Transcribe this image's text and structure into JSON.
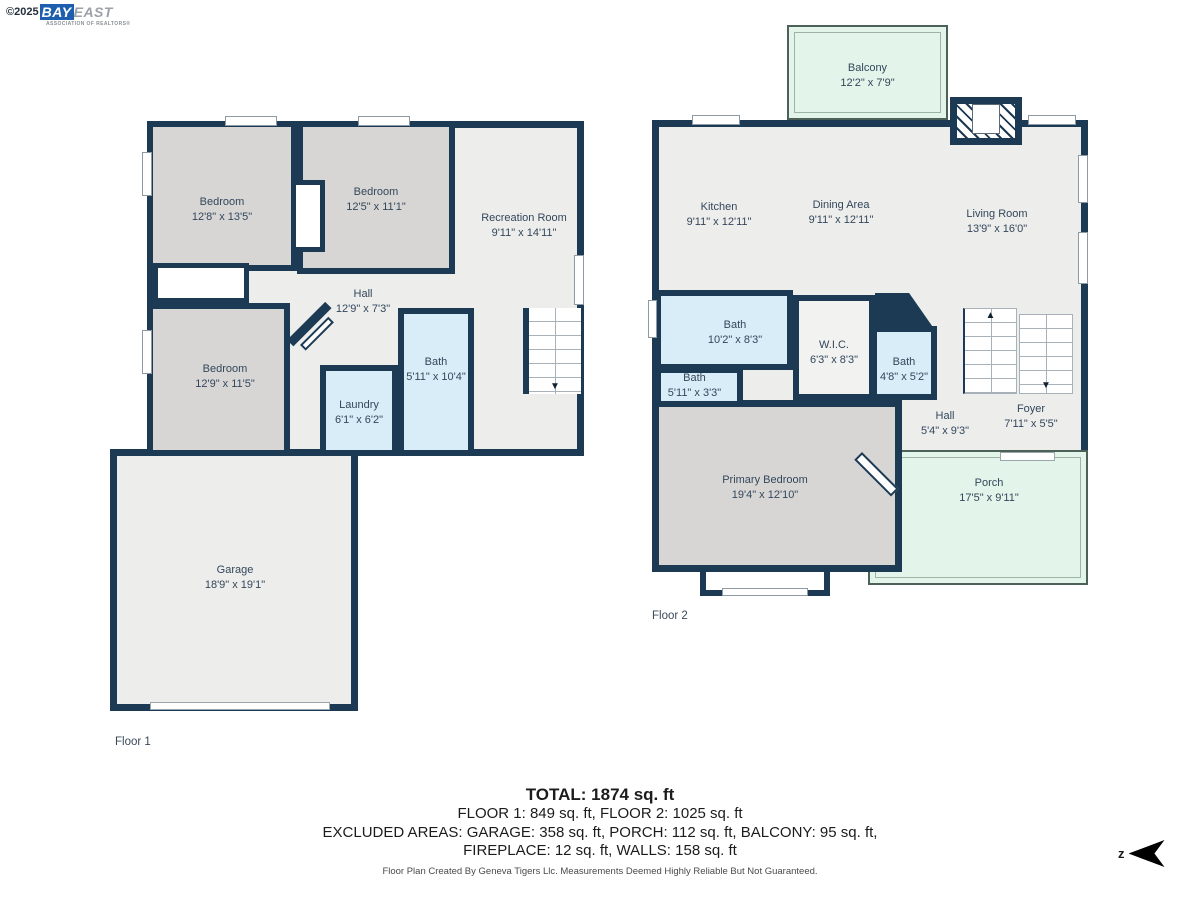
{
  "logo": {
    "copyright": "©2025",
    "brand_primary": "BAY",
    "brand_secondary": "EAST",
    "tagline": "ASSOCIATION OF REALTORS®"
  },
  "floor1": {
    "tag": "Floor 1",
    "rooms": {
      "bedroom_top_left": {
        "name": "Bedroom",
        "dims": "12'8\" x 13'5\""
      },
      "bedroom_top_mid": {
        "name": "Bedroom",
        "dims": "12'5\" x 11'1\""
      },
      "recreation": {
        "name": "Recreation Room",
        "dims": "9'11\" x 14'11\""
      },
      "hall": {
        "name": "Hall",
        "dims": "12'9\" x 7'3\""
      },
      "bedroom_left": {
        "name": "Bedroom",
        "dims": "12'9\" x 11'5\""
      },
      "bath": {
        "name": "Bath",
        "dims": "5'11\" x 10'4\""
      },
      "laundry": {
        "name": "Laundry",
        "dims": "6'1\" x 6'2\""
      },
      "garage": {
        "name": "Garage",
        "dims": "18'9\" x 19'1\""
      }
    }
  },
  "floor2": {
    "tag": "Floor 2",
    "rooms": {
      "balcony": {
        "name": "Balcony",
        "dims": "12'2\" x 7'9\""
      },
      "kitchen": {
        "name": "Kitchen",
        "dims": "9'11\" x 12'11\""
      },
      "dining": {
        "name": "Dining Area",
        "dims": "9'11\" x 12'11\""
      },
      "living": {
        "name": "Living Room",
        "dims": "13'9\" x 16'0\""
      },
      "bath_main": {
        "name": "Bath",
        "dims": "10'2\" x 8'3\""
      },
      "wic": {
        "name": "W.I.C.",
        "dims": "6'3\" x 8'3\""
      },
      "bath_small": {
        "name": "Bath",
        "dims": "4'8\" x 5'2\""
      },
      "bath_half": {
        "name": "Bath",
        "dims": "5'11\" x 3'3\""
      },
      "hall": {
        "name": "Hall",
        "dims": "5'4\" x 9'3\""
      },
      "foyer": {
        "name": "Foyer",
        "dims": "7'11\" x 5'5\""
      },
      "primary_bedroom": {
        "name": "Primary Bedroom",
        "dims": "19'4\" x 12'10\""
      },
      "porch": {
        "name": "Porch",
        "dims": "17'5\" x 9'11\""
      }
    }
  },
  "summary": {
    "total": "TOTAL: 1874 sq. ft",
    "floors": "FLOOR 1: 849 sq. ft, FLOOR 2: 1025 sq. ft",
    "excluded": "EXCLUDED AREAS: GARAGE: 358 sq. ft, PORCH: 112 sq. ft, BALCONY: 95 sq. ft,",
    "excluded2": "FIREPLACE: 12 sq. ft, WALLS: 158 sq. ft"
  },
  "disclaimer": "Floor Plan Created By Geneva Tigers Llc. Measurements Deemed Highly Reliable But Not Guaranteed.",
  "compass": {
    "label": "z"
  },
  "colors": {
    "wall": "#1C3A53",
    "floor_fill": "#EDEDEC",
    "bedroom_fill": "#D7D6D5",
    "bath_fill": "#D9EDF8",
    "outdoor_fill": "#E3F4EA",
    "logo_blue": "#1D5FAE"
  }
}
